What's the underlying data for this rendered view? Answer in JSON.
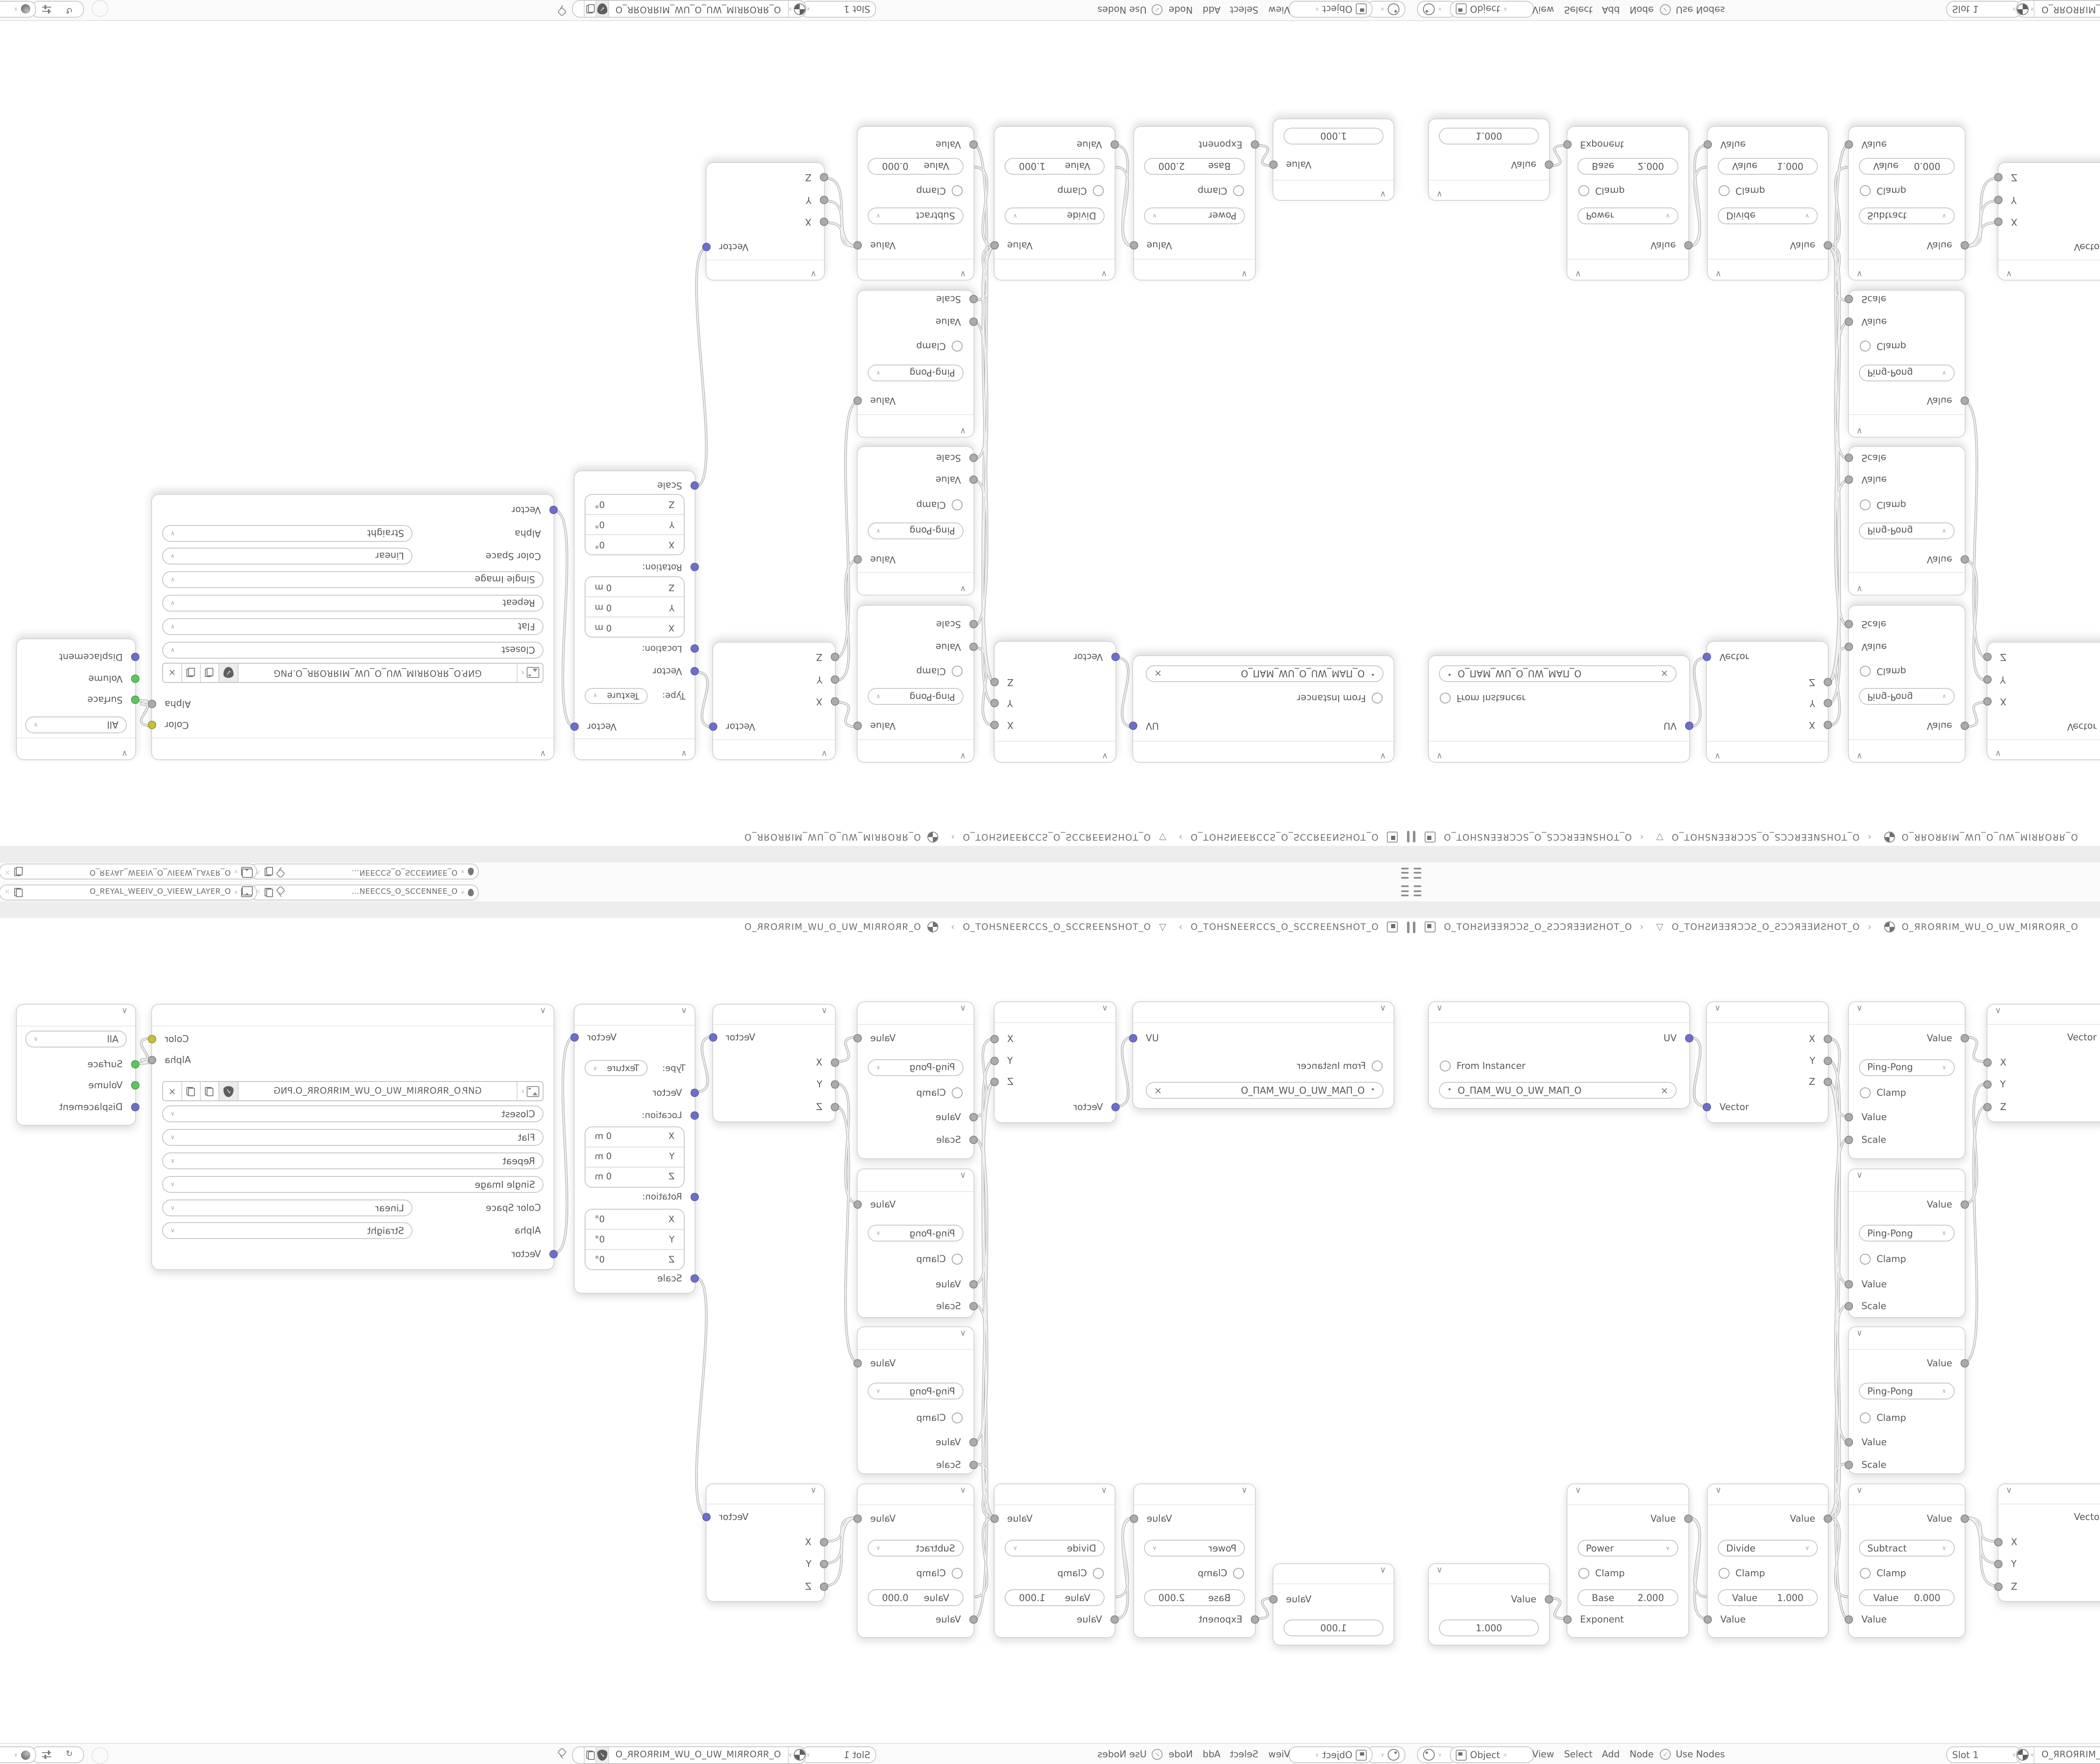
{
  "topbar": {
    "scene_name": "O_ƎƎИИƎƆƆƧ_O_ƧƆƆƎƎИ…",
    "view_layer_name": "O_ЯƎYA⅃_WƎƎIV_O_VIƎƎW_⅃AYƎЯ_O"
  },
  "breadcrumb": {
    "scene": "O_TOHƧИƎƎЯƆƆƧ_O_ƧƆƆЯƎƎИƧHOT_O",
    "object": "O_TOHƧИƎƎЯƆƆƧ_O_ƧƆƆЯƎƎИƧHOT_O",
    "material": "O_ЯROЯRIM_WU_O_UW_MIЯROЯR_O"
  },
  "nodes": {
    "uv_map": {
      "output": "UV",
      "from_instancer": "From Instancer",
      "map_name": "O_ПAM_WU_O_UW_MAП_O",
      "map_prefix": "•"
    },
    "separate_xyz": {
      "x": "X",
      "y": "Y",
      "z": "Z",
      "input": "Vector"
    },
    "math_x": {
      "output": "Value",
      "operation": "Ping-Pong",
      "clamp": "Clamp",
      "input1": "Value",
      "input2": "Scale"
    },
    "math_y": {
      "output": "Value",
      "operation": "Ping-Pong",
      "clamp": "Clamp",
      "input1": "Value",
      "input2": "Scale"
    },
    "math_z": {
      "output": "Value",
      "operation": "Ping-Pong",
      "clamp": "Clamp",
      "input1": "Value",
      "input2": "Scale"
    },
    "combine_top": {
      "output": "Vector",
      "x": "X",
      "y": "Y",
      "z": "Z"
    },
    "mapping": {
      "output": "Vector",
      "type_label": "Type:",
      "type_value": "Texture",
      "input": "Vector",
      "location_label": "Location:",
      "rotation_label": "Rotation:",
      "scale_label": "Scale",
      "loc_x_label": "X",
      "loc_x": "0 m",
      "loc_y_label": "Y",
      "loc_y": "0 m",
      "loc_z_label": "Z",
      "loc_z": "0 m",
      "rot_x_label": "X",
      "rot_x": "0°",
      "rot_y_label": "Y",
      "rot_y": "0°",
      "rot_z_label": "Z",
      "rot_z": "0°"
    },
    "image_texture": {
      "color_output": "Color",
      "alpha_output": "Alpha",
      "filename": "GИP.O_ЯROЯRIM_WU_O_UW_MIЯROЯR_O.PNG",
      "interpolation": "Closest",
      "projection": "Flat",
      "extension": "Repeat",
      "source": "Single Image",
      "color_space_label": "Color Space",
      "color_space": "Linear",
      "alpha_label": "Alpha",
      "alpha_mode": "Straight",
      "vector_input": "Vector"
    },
    "material_output": {
      "target": "All",
      "surface": "Surface",
      "volume": "Volume",
      "displacement": "Displacement"
    },
    "value": {
      "output": "Value",
      "value": "1.000"
    },
    "power": {
      "output": "Value",
      "operation": "Power",
      "clamp": "Clamp",
      "field_label": "Base",
      "field_value": "2.000",
      "input": "Exponent"
    },
    "divide": {
      "output": "Value",
      "operation": "Divide",
      "clamp": "Clamp",
      "field_label": "Value",
      "field_value": "1.000",
      "input": "Value"
    },
    "subtract": {
      "output": "Value",
      "operation": "Subtract",
      "clamp": "Clamp",
      "field_label": "Value",
      "field_value": "0.000",
      "input": "Value"
    },
    "combine_bottom": {
      "output": "Vector",
      "x": "X",
      "y": "Y",
      "z": "Z"
    }
  },
  "footer": {
    "mode": "Object",
    "menu_view": "View",
    "menu_select": "Select",
    "menu_add": "Add",
    "menu_node": "Node",
    "use_nodes": "Use Nodes",
    "slot": "Slot 1",
    "material": "O_ЯROЯRIM_WU_O_UW_MIЯROЯR_O"
  },
  "icons": {
    "collapse_chevron": "∨",
    "dropdown_chevron": "∨",
    "breadcrumb_separator": "›",
    "close": "×",
    "check": "✓",
    "orbit": "↺",
    "object_data_glyph": "▽"
  },
  "colors": {
    "vector_socket": "#6d6dd0",
    "value_socket": "#ababab",
    "color_socket": "#c9c22e",
    "shader_socket": "#5cc75c",
    "noodle": "#bcbcbc",
    "bar_bg": "#fbfbfb"
  }
}
